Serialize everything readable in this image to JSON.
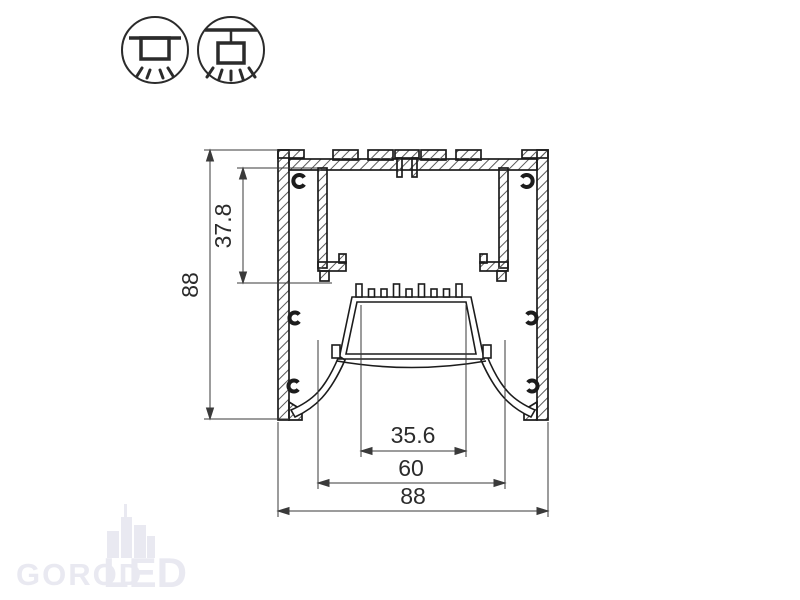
{
  "title": "Aluminium LED profile cross-section drawing",
  "colors": {
    "background": "#ffffff",
    "line": "#1c1c1c",
    "dim_line": "#3a3a3a",
    "hatch": "#5a5a5a",
    "watermark": "#e9e9f1"
  },
  "mount_icons": {
    "surface": {
      "name": "surface-ceiling-mount-icon"
    },
    "pendant": {
      "name": "pendant-suspension-mount-icon"
    }
  },
  "drawing": {
    "type": "profile-cross-section",
    "dimensions": {
      "overall_height": "88",
      "recess_depth": "37.8",
      "led_shelf_width": "35.6",
      "inner_opening_width": "60",
      "overall_width": "88"
    }
  },
  "watermark": {
    "gorod": "GOROD",
    "led": "LED"
  }
}
